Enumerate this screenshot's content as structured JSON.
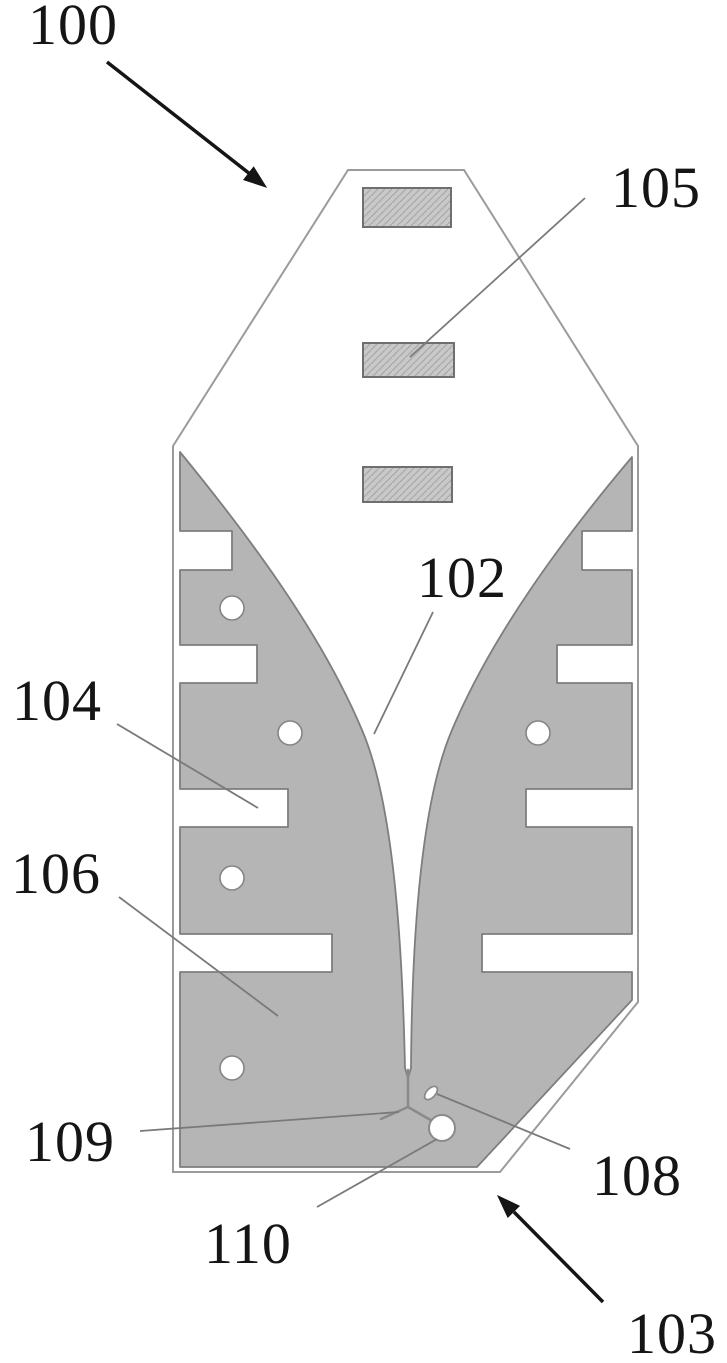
{
  "figure_labels": {
    "ref_100": "100",
    "ref_105": "105",
    "ref_102": "102",
    "ref_104": "104",
    "ref_106": "106",
    "ref_109": "109",
    "ref_110": "110",
    "ref_108": "108",
    "ref_103": "103"
  },
  "colors": {
    "background": "#ffffff",
    "substrate_outline": "#9b9b9b",
    "metal_fill": "#b5b5b5",
    "metal_outline": "#7e7e7e",
    "hatch_fill": "#c9c9c9",
    "hatch_line": "#a9a9a9",
    "hatch_border": "#6f6f6f",
    "hole_fill": "#ffffff",
    "hole_outline": "#858585",
    "feed_line": "#8a8a8a",
    "leader_line": "#7a7a7a",
    "annotation": "#151515"
  }
}
